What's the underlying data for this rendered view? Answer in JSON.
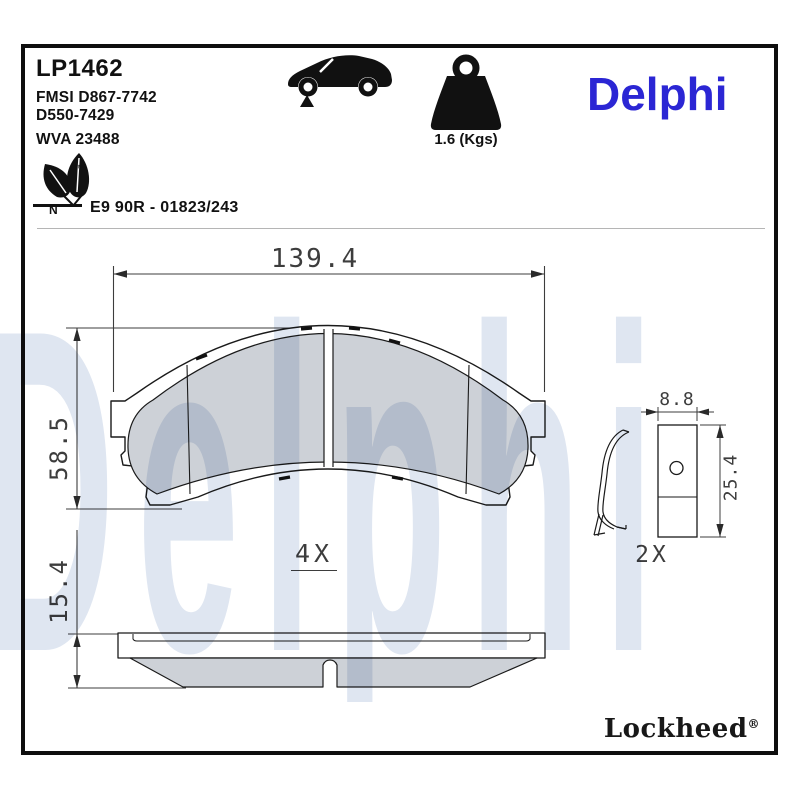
{
  "header": {
    "part_number": "LP1462",
    "fmsi_line1": "FMSI D867-7742",
    "fmsi_line2": "D550-7429",
    "wva": "WVA 23488",
    "weight": "1.6 (Kgs)",
    "brand": "Delphi",
    "approval": "E9 90R - 01823/243",
    "eco_mark_letter": "N",
    "trademark": "™"
  },
  "drawing": {
    "front_view": {
      "width_dim": "139.4",
      "height_dim": "58.5",
      "quantity": "4X"
    },
    "side_view": {
      "thickness_dim": "15.4"
    },
    "hardware": {
      "width_dim": "8.8",
      "height_dim": "25.4",
      "quantity": "2X"
    }
  },
  "footer": {
    "brand": "Lockheed",
    "reg": "®"
  },
  "watermark": "Delphi",
  "icons": [
    "car-icon",
    "weight-icon",
    "leaf-icon"
  ],
  "colors": {
    "brand_blue": "#2B26D4",
    "watermark_blue": "#DFE6F1",
    "friction_gray": "#CDD1D7",
    "line_black": "#1A1A1A",
    "dim_gray": "#3D3D3D"
  }
}
